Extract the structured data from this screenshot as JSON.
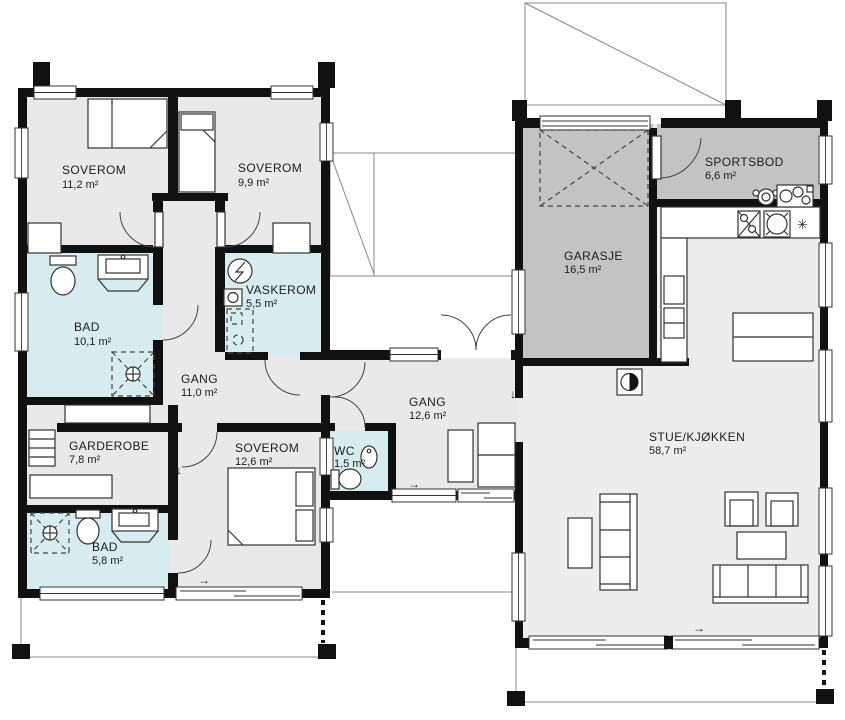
{
  "colors": {
    "wall": "#111111",
    "floor": "#e9e9e9",
    "floor_living": "#ededed",
    "wet_room": "#d6ecef",
    "storage_grey": "#c3c3c3",
    "furniture_stroke": "#333333"
  },
  "rooms": [
    {
      "id": "soverom-1",
      "name": "SOVEROM",
      "area": "11,2 m²"
    },
    {
      "id": "soverom-2",
      "name": "SOVEROM",
      "area": "9,9 m²"
    },
    {
      "id": "bad-1",
      "name": "BAD",
      "area": "10,1 m²"
    },
    {
      "id": "vaskerom",
      "name": "VASKEROM",
      "area": "5,5 m²"
    },
    {
      "id": "gang-1",
      "name": "GANG",
      "area": "11,0 m²"
    },
    {
      "id": "garderobe",
      "name": "GARDEROBE",
      "area": "7,8 m²"
    },
    {
      "id": "soverom-3",
      "name": "SOVEROM",
      "area": "12,6 m²"
    },
    {
      "id": "bad-2",
      "name": "BAD",
      "area": "5,8 m²"
    },
    {
      "id": "wc",
      "name": "WC",
      "area": "1,5 m²"
    },
    {
      "id": "gang-2",
      "name": "GANG",
      "area": "12,6 m²"
    },
    {
      "id": "garasje",
      "name": "GARASJE",
      "area": "16,5 m²"
    },
    {
      "id": "sportsbod",
      "name": "SPORTSBOD",
      "area": "6,6 m²"
    },
    {
      "id": "stue-kjokken",
      "name": "STUE/KJØKKEN",
      "area": "58,7 m²"
    }
  ],
  "symbols": {
    "arrow_right": "→",
    "arrow_down": "↓",
    "asterisk": "✳"
  }
}
